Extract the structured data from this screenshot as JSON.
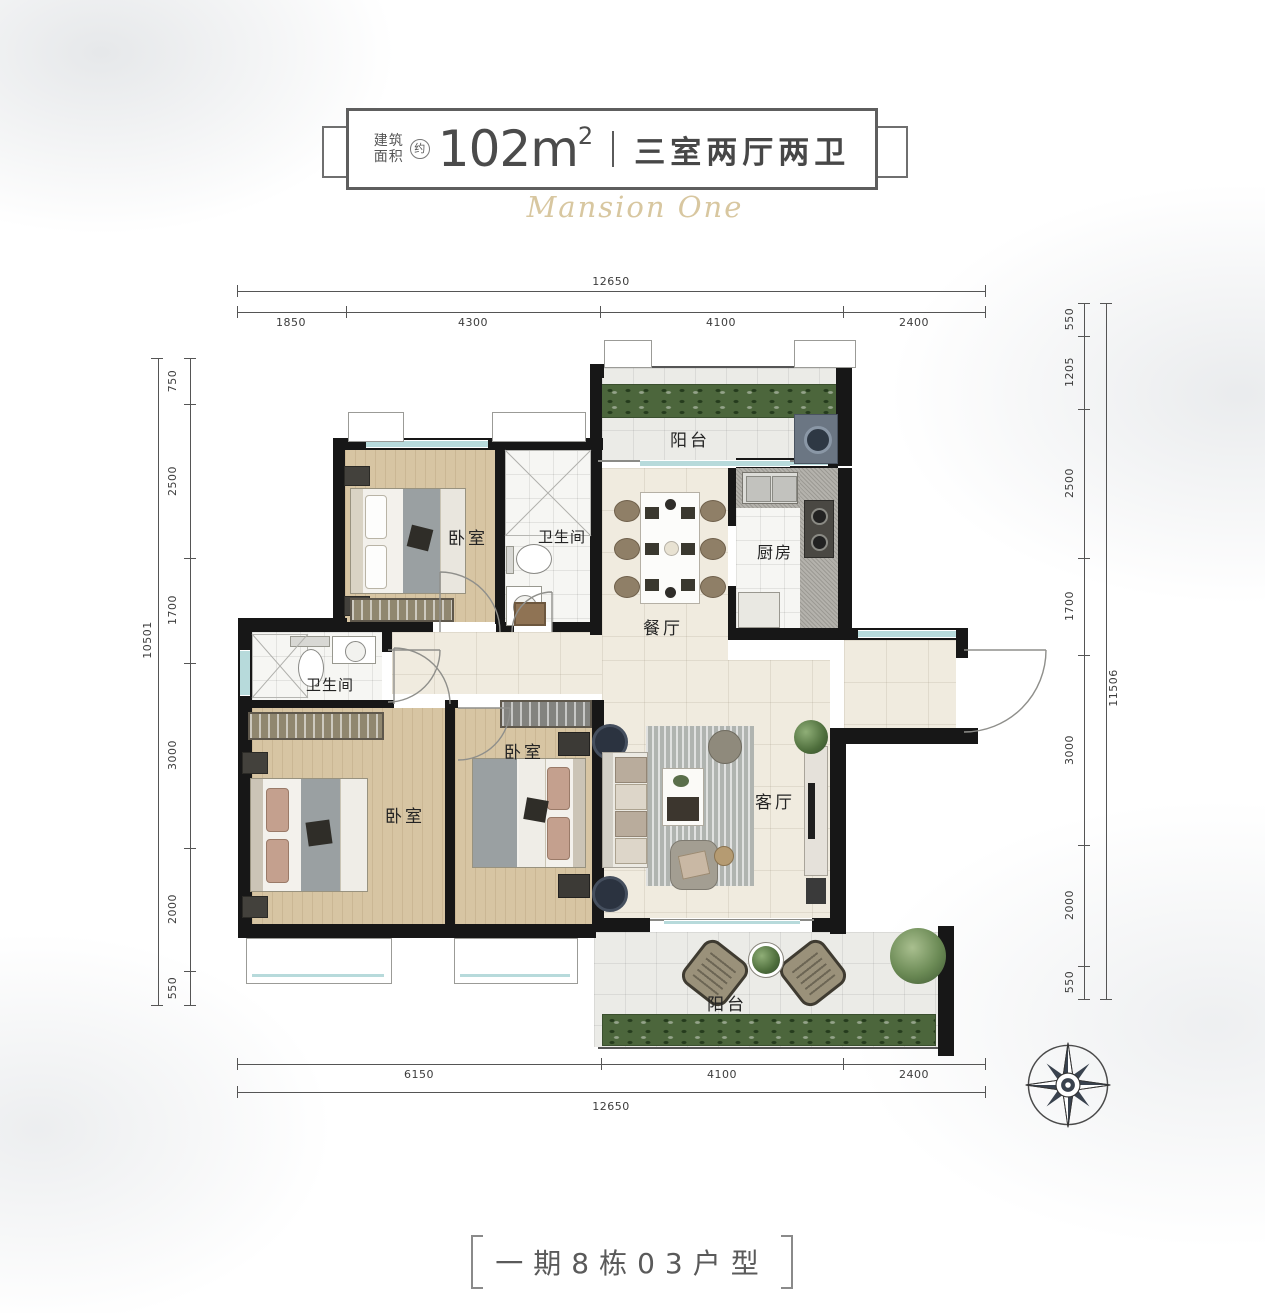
{
  "header": {
    "area_prefix_line1": "建筑",
    "area_prefix_line2": "面积",
    "area_approx": "约",
    "area_value": "102m",
    "area_exp": "2",
    "unit_layout": "三室两厅两卫",
    "watermark": "Mansion One"
  },
  "rooms": {
    "balcony_top": "阳台",
    "bedroom_top": "卧室",
    "bathroom_top": "卫生间",
    "dining": "餐厅",
    "kitchen": "厨房",
    "bathroom_mid": "卫生间",
    "bedroom_master": "卧室",
    "bedroom_mid": "卧室",
    "living": "客厅",
    "balcony_bottom": "阳台"
  },
  "dimensions": {
    "top_total": "12650",
    "top_segments": [
      "1850",
      "4300",
      "4100",
      "2400"
    ],
    "bottom_total": "12650",
    "bottom_segments": [
      "6150",
      "4100",
      "2400"
    ],
    "left_total": "10501",
    "left_segments": [
      "750",
      "2500",
      "1700",
      "3000",
      "2000",
      "550"
    ],
    "right_total": "11506",
    "right_segments": [
      "550",
      "1205",
      "2500",
      "1700",
      "3000",
      "2000",
      "550"
    ]
  },
  "footer": {
    "unit_label": "一期8栋03户型"
  },
  "colors": {
    "wall": "#171717",
    "window_glass": "#b7dadb",
    "planter_green": "#4c663c",
    "wood_floor": "#d7c5a3",
    "tile_cream": "#f0ebdf",
    "title_text": "#4b4b4b",
    "watermark_gold": "#d8c7a0"
  }
}
